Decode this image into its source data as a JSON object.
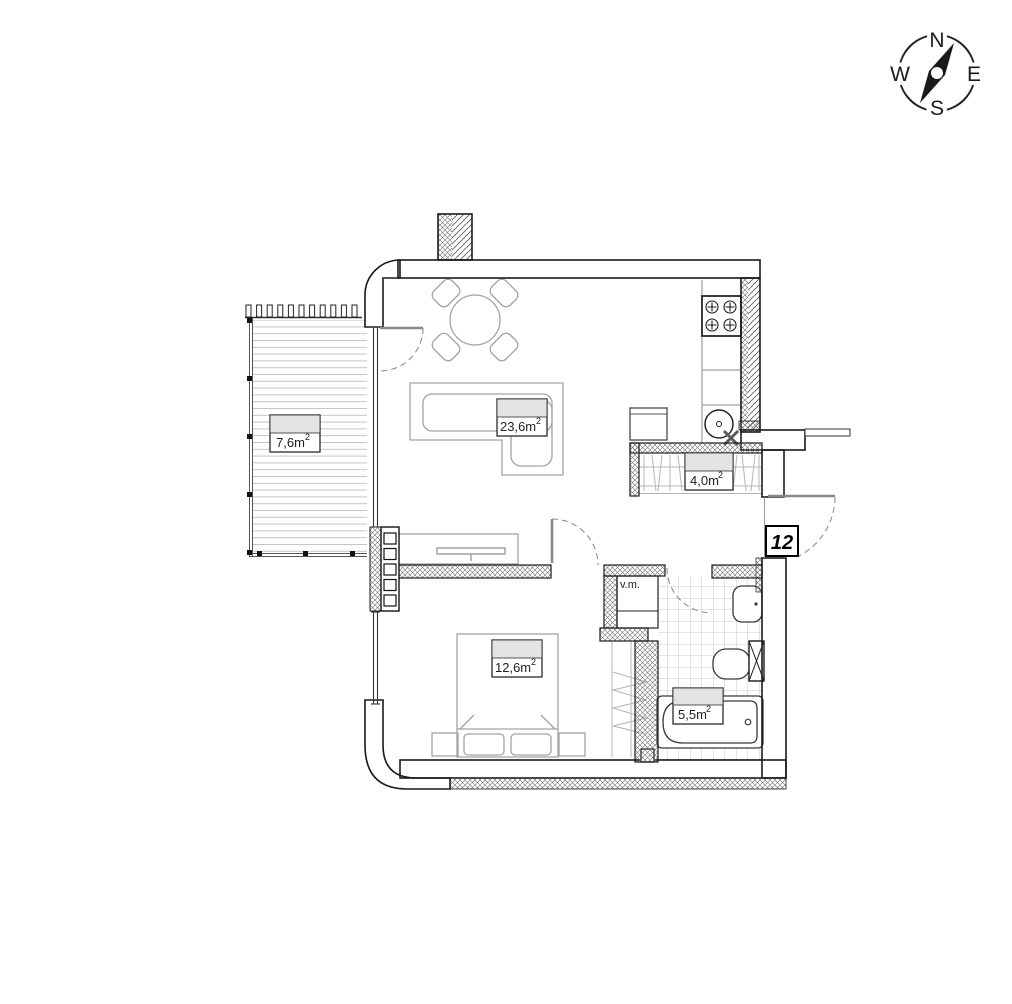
{
  "compass": {
    "north": "N",
    "east": "E",
    "south": "S",
    "west": "W"
  },
  "unit": {
    "number": "12"
  },
  "rooms": {
    "balcony": {
      "area": "7,6m",
      "sup": "2"
    },
    "living": {
      "area": "23,6m",
      "sup": "2"
    },
    "hallway": {
      "area": "4,0m",
      "sup": "2"
    },
    "bedroom": {
      "area": "12,6m",
      "sup": "2"
    },
    "bathroom": {
      "area": "5,5m",
      "sup": "2"
    }
  },
  "annotations": {
    "washing_machine": "v.m."
  },
  "colors": {
    "wall_line": "#1a1a1a",
    "hatch": "#606060",
    "furniture": "#a3a3a3",
    "label_fill": "#e3e3e3",
    "tile": "#c9c9c9"
  }
}
